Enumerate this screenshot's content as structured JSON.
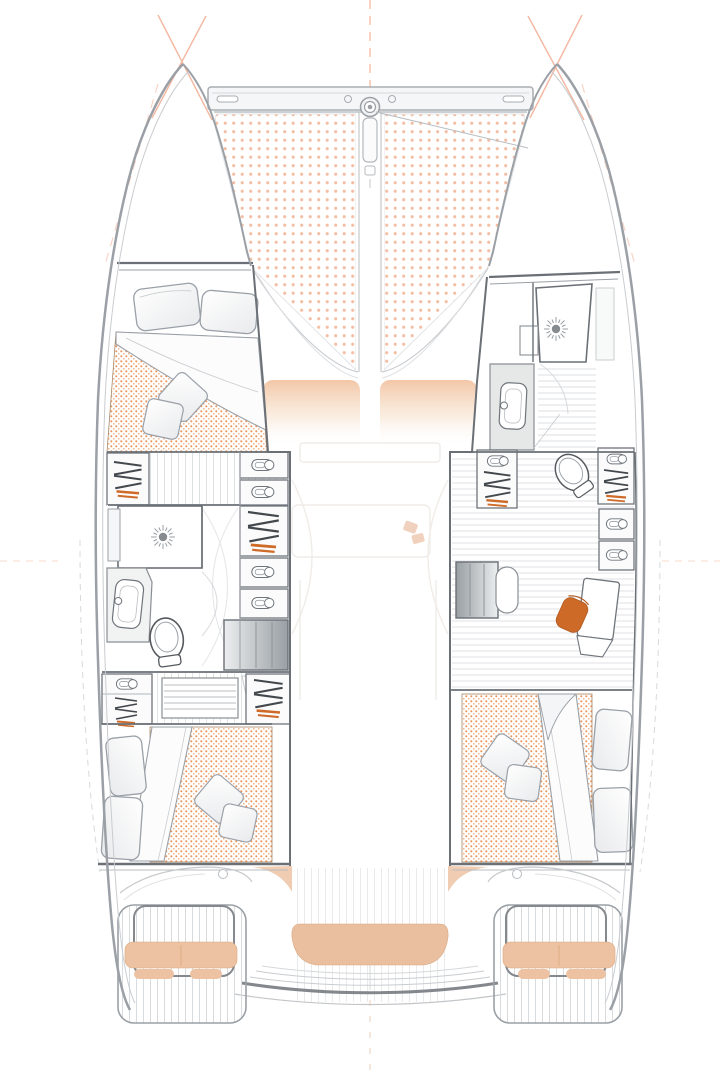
{
  "title": "Catamaran interior deck plan — top view",
  "type": "floorplan",
  "vessel": {
    "kind": "sailing catamaran",
    "view": "overhead deck / accommodation plan",
    "hulls": 2
  },
  "colors": {
    "bg": "#ffffff",
    "accent": "#cf6b28",
    "chair": "#cd6a28",
    "mattress_dot": "#e9965d",
    "mattress_dot2": "#f0a877",
    "tramp_dot": "#f2b79a",
    "cushion_tan": "#ecc2a2",
    "bench_tan": "#eabf9f",
    "seat_top": "#f2c3a2",
    "hull_line": "#9aa0a6",
    "hull_line_light": "#c9ccd0",
    "wall": "#6a7076",
    "furn": "#6f757b",
    "light_line": "#d5d8da",
    "floor_line": "#dcdfe1",
    "rig_line": "#f0a183",
    "ghost": "#f0ece8",
    "hanger_dark": "#43484d",
    "steel_dark": "#84888d"
  },
  "plan": {
    "foredeck": {
      "crossbeam": {
        "handle_slots": 2,
        "windlass": 1,
        "anchor_chute": 1,
        "bridle_line": 1
      },
      "trampoline_panels": 2,
      "bow_rigging_guides": 2,
      "coachroof_seat_pads": 2
    },
    "port_hull": {
      "forward_cabin": {
        "type": "double berth",
        "bed_pillows": 2,
        "throw_pillows": 2,
        "mattress": "dotted"
      },
      "midship": {
        "bathroom": {
          "shower": 1,
          "sink": 1,
          "toilet": 1
        },
        "wardrobes_with_hangers": 4,
        "drawer_units": 5,
        "companionway_steps": 1,
        "ladder_steps": 1
      },
      "aft_cabin": {
        "type": "double berth",
        "bed_pillows": 2,
        "throw_pillows": 2,
        "mattress": "dotted"
      },
      "stern": {
        "davit_frame": 1,
        "bench_cushion": 1,
        "seat_pads": 2,
        "swim_platform": 1
      }
    },
    "starboard_hull": {
      "forward_bathroom": {
        "shower": 1,
        "sink": 1,
        "toilet": 1
      },
      "midship_office": {
        "desk": 1,
        "office_chair": 1,
        "companionway_stairs": 1,
        "wardrobes_with_hangers": 2,
        "drawer_units": 4
      },
      "aft_cabin": {
        "type": "double berth",
        "bed_pillows": 2,
        "throw_pillows": 2,
        "mattress": "dotted"
      },
      "stern": {
        "davit_frame": 1,
        "bench_cushion": 1,
        "seat_pads": 2,
        "swim_platform": 1
      }
    },
    "aft_cockpit": {
      "center_bench": 1,
      "side_seat_pads": 2,
      "transom_beam": 1,
      "centerline_guide": 1
    },
    "salon": {
      "rendering": "ghosted / faded",
      "galley_hint": true
    }
  }
}
